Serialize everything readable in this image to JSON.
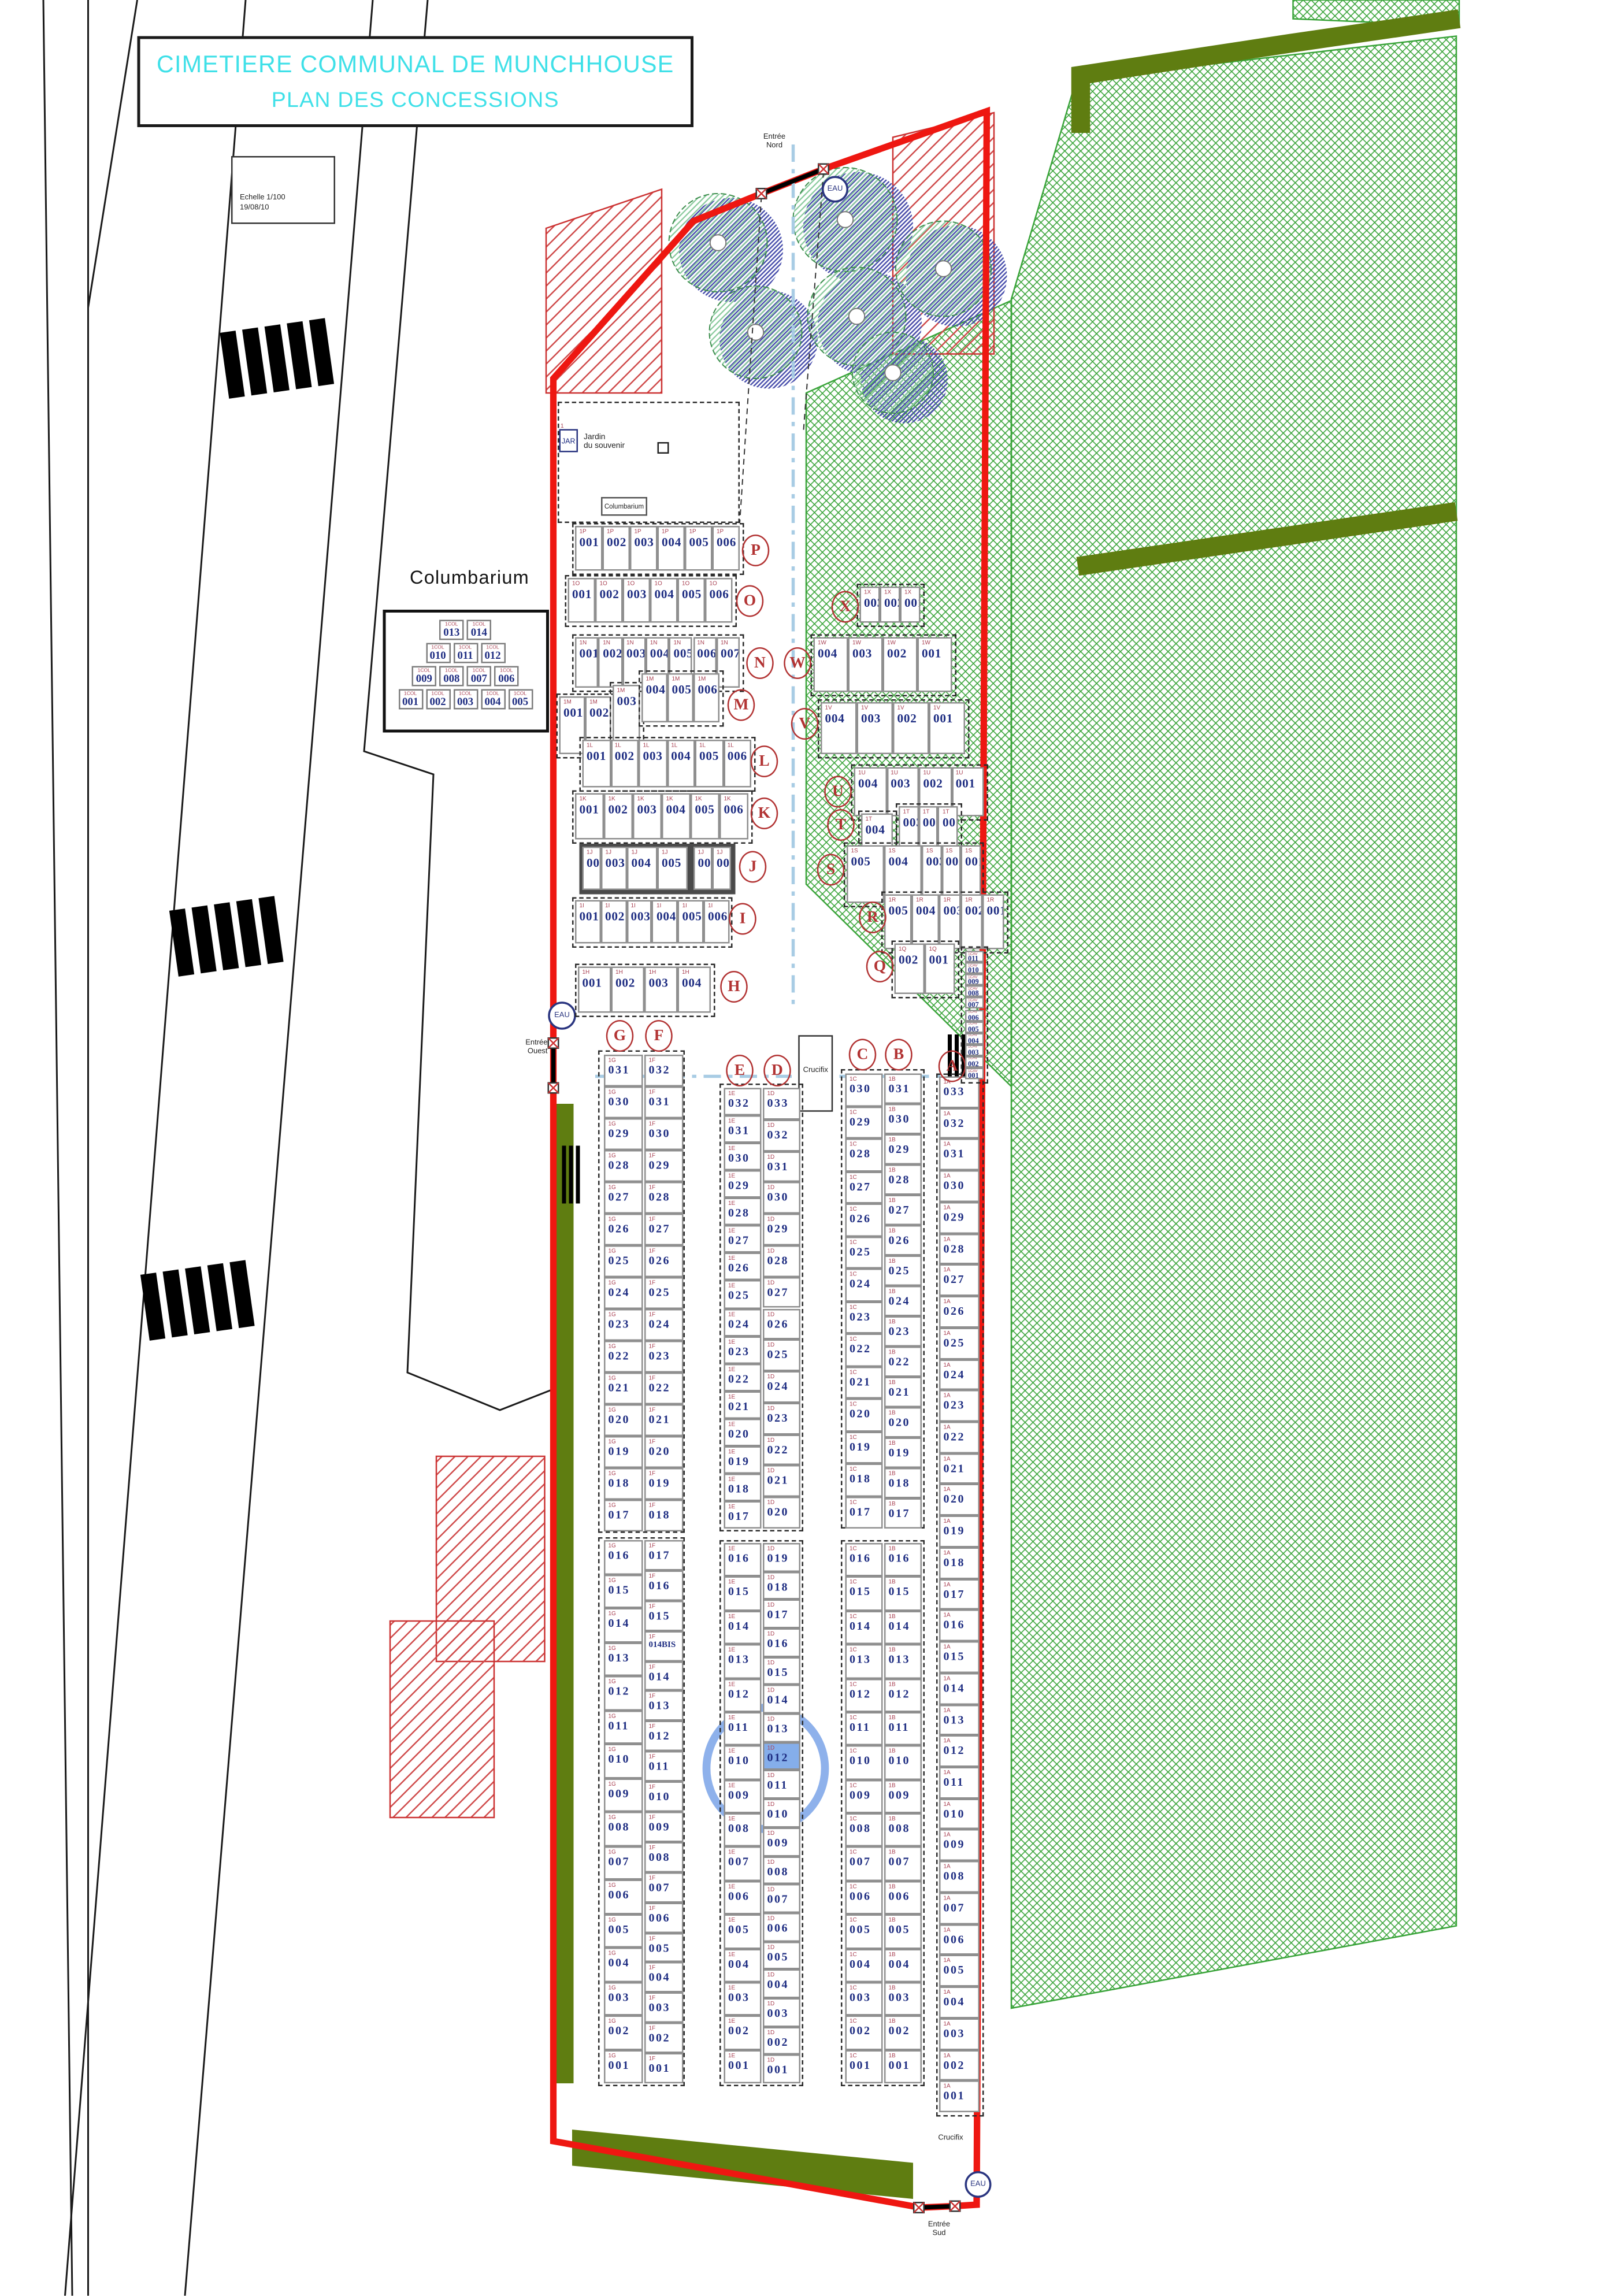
{
  "title": {
    "line1": "CIMETIERE COMMUNAL DE MUNCHHOUSE",
    "line2": "PLAN DES CONCESSIONS"
  },
  "scale_box": {
    "line1": "Echelle 1/100",
    "line2": "19/08/10"
  },
  "labels": {
    "entree_nord_1": "Entrée",
    "entree_nord_2": "Nord",
    "entree_ouest_1": "Entrée",
    "entree_ouest_2": "Ouest",
    "entree_sud_1": "Entrée",
    "entree_sud_2": "Sud",
    "eau": "EAU",
    "crucifix": "Crucifix",
    "jardin_1": "Jardin",
    "jardin_2": "du souvenir",
    "jar": "JAR",
    "jar_sup": "1",
    "columbarium_plan": "Columbarium",
    "columbarium_inset": "Columbarium"
  },
  "top_rows": [
    {
      "letter": "P",
      "prefix": "1P",
      "cells": [
        "001",
        "002",
        "003",
        "004",
        "005",
        "006"
      ]
    },
    {
      "letter": "O",
      "prefix": "1O",
      "cells": [
        "001",
        "002",
        "003",
        "004",
        "005",
        "006"
      ]
    },
    {
      "letter": "N",
      "prefix": "1N",
      "cells": [
        "001",
        "002",
        "003",
        "004",
        "005",
        "006",
        "007"
      ]
    },
    {
      "letter": "M",
      "prefix": "1M",
      "cells": [
        "001",
        "002",
        "003",
        "004",
        "005",
        "006"
      ]
    },
    {
      "letter": "L",
      "prefix": "1L",
      "cells": [
        "001",
        "002",
        "003",
        "004",
        "005",
        "006"
      ]
    },
    {
      "letter": "K",
      "prefix": "1K",
      "cells": [
        "001",
        "002",
        "003",
        "004",
        "005",
        "006"
      ]
    },
    {
      "letter": "J",
      "prefix": "1J",
      "cells": [
        "002",
        "003",
        "004",
        "005",
        "007",
        "008"
      ]
    },
    {
      "letter": "I",
      "prefix": "1I",
      "cells": [
        "001",
        "002",
        "003",
        "004",
        "005",
        "006"
      ]
    },
    {
      "letter": "H",
      "prefix": "1H",
      "cells": [
        "001",
        "002",
        "003",
        "004"
      ]
    }
  ],
  "right_rows": [
    {
      "letter": "X",
      "prefix": "1X",
      "cells": [
        "003",
        "002",
        "001"
      ]
    },
    {
      "letter": "W",
      "prefix": "1W",
      "cells": [
        "004",
        "003",
        "002",
        "001"
      ]
    },
    {
      "letter": "V",
      "prefix": "1V",
      "cells": [
        "004",
        "003",
        "002",
        "001"
      ]
    },
    {
      "letter": "U",
      "prefix": "1U",
      "cells": [
        "004",
        "003",
        "002",
        "001"
      ]
    },
    {
      "letter": "T",
      "prefix": "1T",
      "cells": [
        "004",
        "003",
        "002",
        "001"
      ]
    },
    {
      "letter": "S",
      "prefix": "1S",
      "cells": [
        "005",
        "004",
        "003",
        "002",
        "001"
      ]
    },
    {
      "letter": "R",
      "prefix": "1R",
      "cells": [
        "005",
        "004",
        "003",
        "002",
        "001"
      ]
    },
    {
      "letter": "Q",
      "prefix": "1Q",
      "cells": [
        "002",
        "001"
      ]
    }
  ],
  "strip": {
    "prefix": "1CAV",
    "cells": [
      "011",
      "010",
      "009",
      "008",
      "007",
      "006",
      "005",
      "004",
      "003",
      "002",
      "001"
    ]
  },
  "columns": {
    "G": {
      "prefix": "1G",
      "cells": [
        "031",
        "030",
        "029",
        "028",
        "027",
        "026",
        "025",
        "024",
        "023",
        "022",
        "021",
        "020",
        "019",
        "018",
        "017",
        "016",
        "015",
        "014",
        "013",
        "012",
        "011",
        "010",
        "009",
        "008",
        "007",
        "006",
        "005",
        "004",
        "003",
        "002",
        "001"
      ]
    },
    "F": {
      "prefix": "1F",
      "cells": [
        "032",
        "031",
        "030",
        "029",
        "028",
        "027",
        "026",
        "025",
        "024",
        "023",
        "022",
        "021",
        "020",
        "019",
        "018",
        "017",
        "016",
        "015",
        "014BIS",
        "014",
        "013",
        "012",
        "011",
        "010",
        "009",
        "008",
        "007",
        "006",
        "005",
        "004",
        "003",
        "002",
        "001"
      ]
    },
    "E": {
      "prefix": "1E",
      "cells": [
        "032",
        "031",
        "030",
        "029",
        "028",
        "027",
        "026",
        "025",
        "024",
        "023",
        "022",
        "021",
        "020",
        "019",
        "018",
        "017",
        "016",
        "015",
        "014",
        "013",
        "012",
        "011",
        "010",
        "009",
        "008",
        "007",
        "006",
        "005",
        "004",
        "003",
        "002",
        "001"
      ]
    },
    "D": {
      "prefix": "1D",
      "cells": [
        "033",
        "032",
        "031",
        "030",
        "029",
        "028",
        "027",
        "026",
        "025",
        "024",
        "023",
        "022",
        "021",
        "020",
        "019",
        "018",
        "017",
        "016",
        "015",
        "014",
        "013",
        "012",
        "011",
        "010",
        "009",
        "008",
        "007",
        "006",
        "005",
        "004",
        "003",
        "002",
        "001"
      ]
    },
    "C": {
      "prefix": "1C",
      "cells": [
        "030",
        "029",
        "028",
        "027",
        "026",
        "025",
        "024",
        "023",
        "022",
        "021",
        "020",
        "019",
        "018",
        "017",
        "016",
        "015",
        "014",
        "013",
        "012",
        "011",
        "010",
        "009",
        "008",
        "007",
        "006",
        "005",
        "004",
        "003",
        "002",
        "001"
      ]
    },
    "B": {
      "prefix": "1B",
      "cells": [
        "031",
        "030",
        "029",
        "028",
        "027",
        "026",
        "025",
        "024",
        "023",
        "022",
        "021",
        "020",
        "019",
        "018",
        "017",
        "016",
        "015",
        "014",
        "013",
        "012",
        "011",
        "010",
        "009",
        "008",
        "007",
        "006",
        "005",
        "004",
        "003",
        "002",
        "001"
      ]
    },
    "A": {
      "prefix": "1A",
      "cells": [
        "033",
        "032",
        "031",
        "030",
        "029",
        "028",
        "027",
        "026",
        "025",
        "024",
        "023",
        "022",
        "021",
        "020",
        "019",
        "018",
        "017",
        "016",
        "015",
        "014",
        "013",
        "012",
        "011",
        "010",
        "009",
        "008",
        "007",
        "006",
        "005",
        "004",
        "003",
        "002",
        "001"
      ]
    }
  },
  "columbarium": {
    "prefix": "1COL",
    "rows": [
      [
        "013",
        "014"
      ],
      [
        "010",
        "011",
        "012"
      ],
      [
        "009",
        "008",
        "007",
        "006"
      ],
      [
        "001",
        "002",
        "003",
        "004",
        "005"
      ]
    ]
  },
  "selection": {
    "column": "D",
    "plot": "012"
  },
  "colors": {
    "title": "#3FE0E8",
    "boundary": "#EE1711",
    "plot_number": "#1E2D82",
    "prefix": "#A84052",
    "row_letter": "#B23333",
    "field_green": "#3AA43A",
    "hedge_olive": "#5F7D11",
    "highlight_blue": "#7AA3E8",
    "water": "#2A3580"
  }
}
